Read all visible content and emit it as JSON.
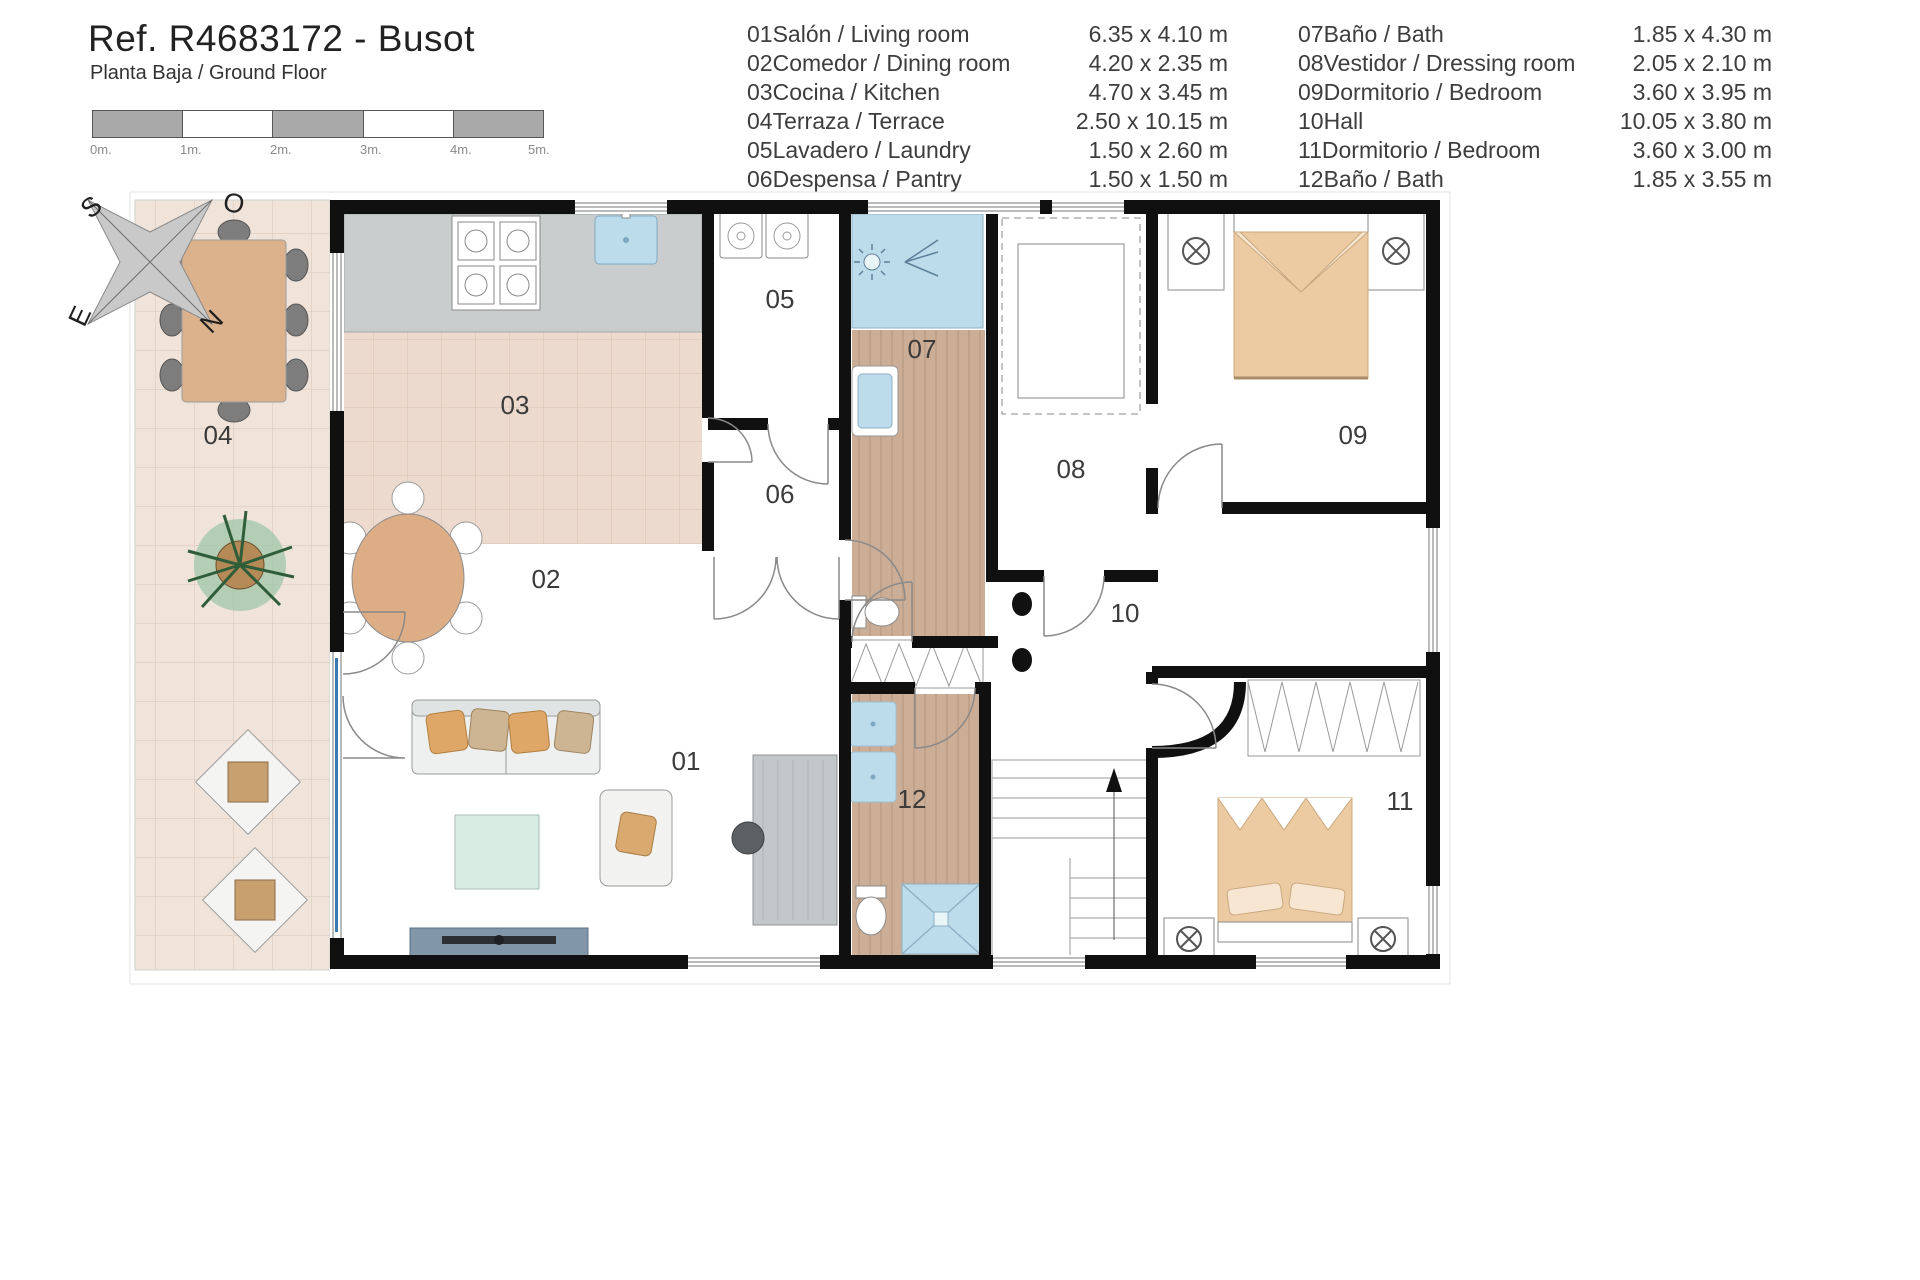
{
  "header": {
    "title": "Ref. R4683172 - Busot",
    "subtitle": "Planta Baja / Ground Floor"
  },
  "scale_bar": {
    "unit_labels": [
      "0m.",
      "1m.",
      "2m.",
      "3m.",
      "4m.",
      "5m."
    ]
  },
  "compass": {
    "north": "N",
    "south": "S",
    "east": "E",
    "west": "O"
  },
  "legend": {
    "left": [
      {
        "num": "01",
        "name": "Salón / Living room",
        "dims": "6.35 x 4.10 m"
      },
      {
        "num": "02",
        "name": "Comedor / Dining room",
        "dims": "4.20 x 2.35 m"
      },
      {
        "num": "03",
        "name": "Cocina / Kitchen",
        "dims": "4.70 x 3.45 m"
      },
      {
        "num": "04",
        "name": "Terraza / Terrace",
        "dims": "2.50 x 10.15 m"
      },
      {
        "num": "05",
        "name": "Lavadero / Laundry",
        "dims": "1.50 x 2.60 m"
      },
      {
        "num": "06",
        "name": "Despensa / Pantry",
        "dims": "1.50 x 1.50 m"
      }
    ],
    "right": [
      {
        "num": "07",
        "name": "Baño / Bath",
        "dims": "1.85 x 4.30 m"
      },
      {
        "num": "08",
        "name": "Vestidor / Dressing room",
        "dims": "2.05 x 2.10 m"
      },
      {
        "num": "09",
        "name": "Dormitorio / Bedroom",
        "dims": "3.60 x 3.95 m"
      },
      {
        "num": "10",
        "name": "Hall",
        "dims": "10.05 x 3.80 m"
      },
      {
        "num": "11",
        "name": "Dormitorio / Bedroom",
        "dims": "3.60 x 3.00 m"
      },
      {
        "num": "12",
        "name": "Baño / Bath",
        "dims": "1.85 x 3.55 m"
      }
    ]
  },
  "plan": {
    "room_numbers": {
      "r01": "01",
      "r02": "02",
      "r03": "03",
      "r04": "04",
      "r05": "05",
      "r06": "06",
      "r07": "07",
      "r08": "08",
      "r09": "09",
      "r10": "10",
      "r11": "11",
      "r12": "12"
    }
  },
  "colors": {
    "wall": "#111111",
    "terrace_tile": "#f0e4da",
    "kitchen_tile": "#ebdacd",
    "wood_floor": "#ccad96",
    "water_blue": "#bcdcec",
    "furniture_tan": "#e2b68b",
    "scale_gray": "#a9a9a9"
  }
}
